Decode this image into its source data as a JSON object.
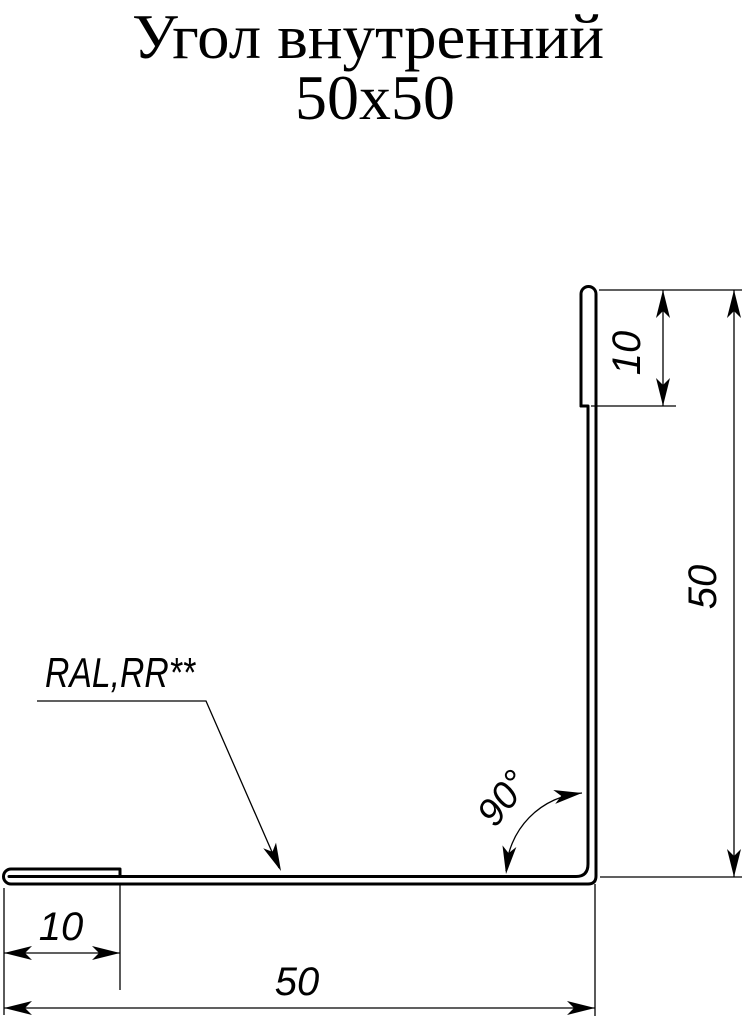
{
  "title": {
    "line1": "Угол внутренний",
    "line2": "50x50"
  },
  "drawing": {
    "type_label": "internal-corner-flashing-profile",
    "material_label": "RAL,RR**",
    "angle_label": "90°",
    "dimensions": {
      "top_hem": "10",
      "right_leg": "50",
      "bottom_hem": "10",
      "bottom_leg": "50"
    },
    "line_color": "#000000",
    "background_color": "#ffffff"
  }
}
